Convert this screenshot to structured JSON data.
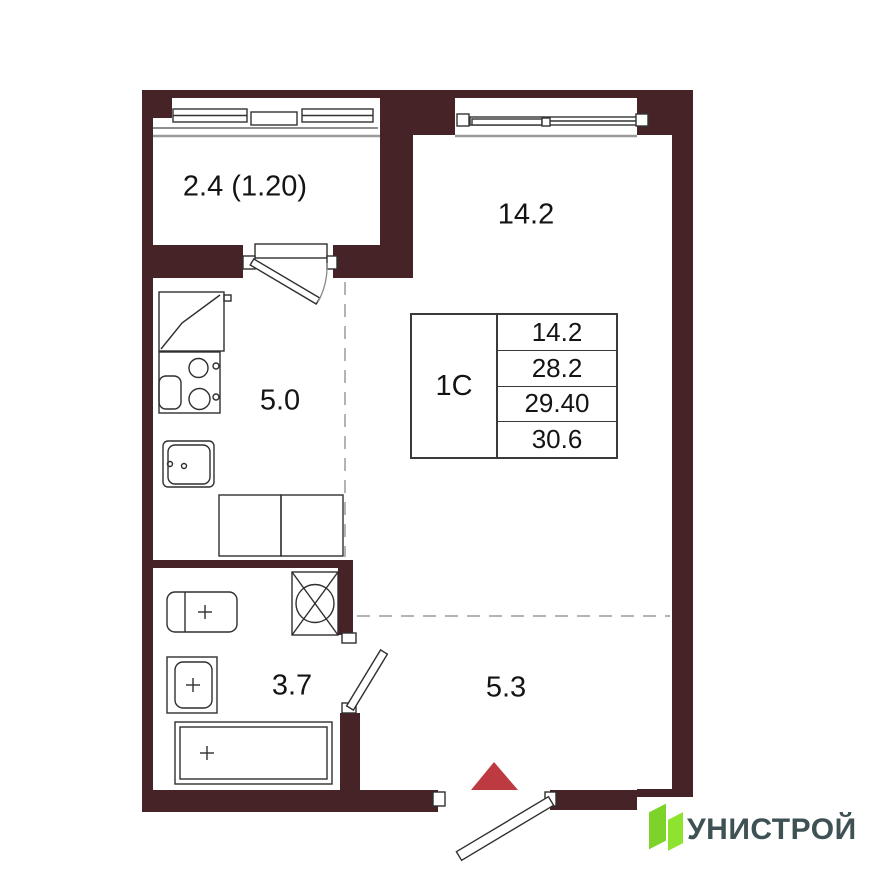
{
  "rooms": {
    "balcony": "2.4 (1.20)",
    "living": "14.2",
    "kitchen": "5.0",
    "bathroom": "3.7",
    "hallway": "5.3"
  },
  "info_table": {
    "type": "1С",
    "values": [
      "14.2",
      "28.2",
      "29.40",
      "30.6"
    ]
  },
  "logo": {
    "text": "УНИСТРОЙ"
  },
  "colors": {
    "wall": "#452326",
    "entrance_marker": "#BD3A40",
    "logo_green": "#7ED32B",
    "logo_green_light": "#8DE32E",
    "logo_text": "#3E5154"
  }
}
